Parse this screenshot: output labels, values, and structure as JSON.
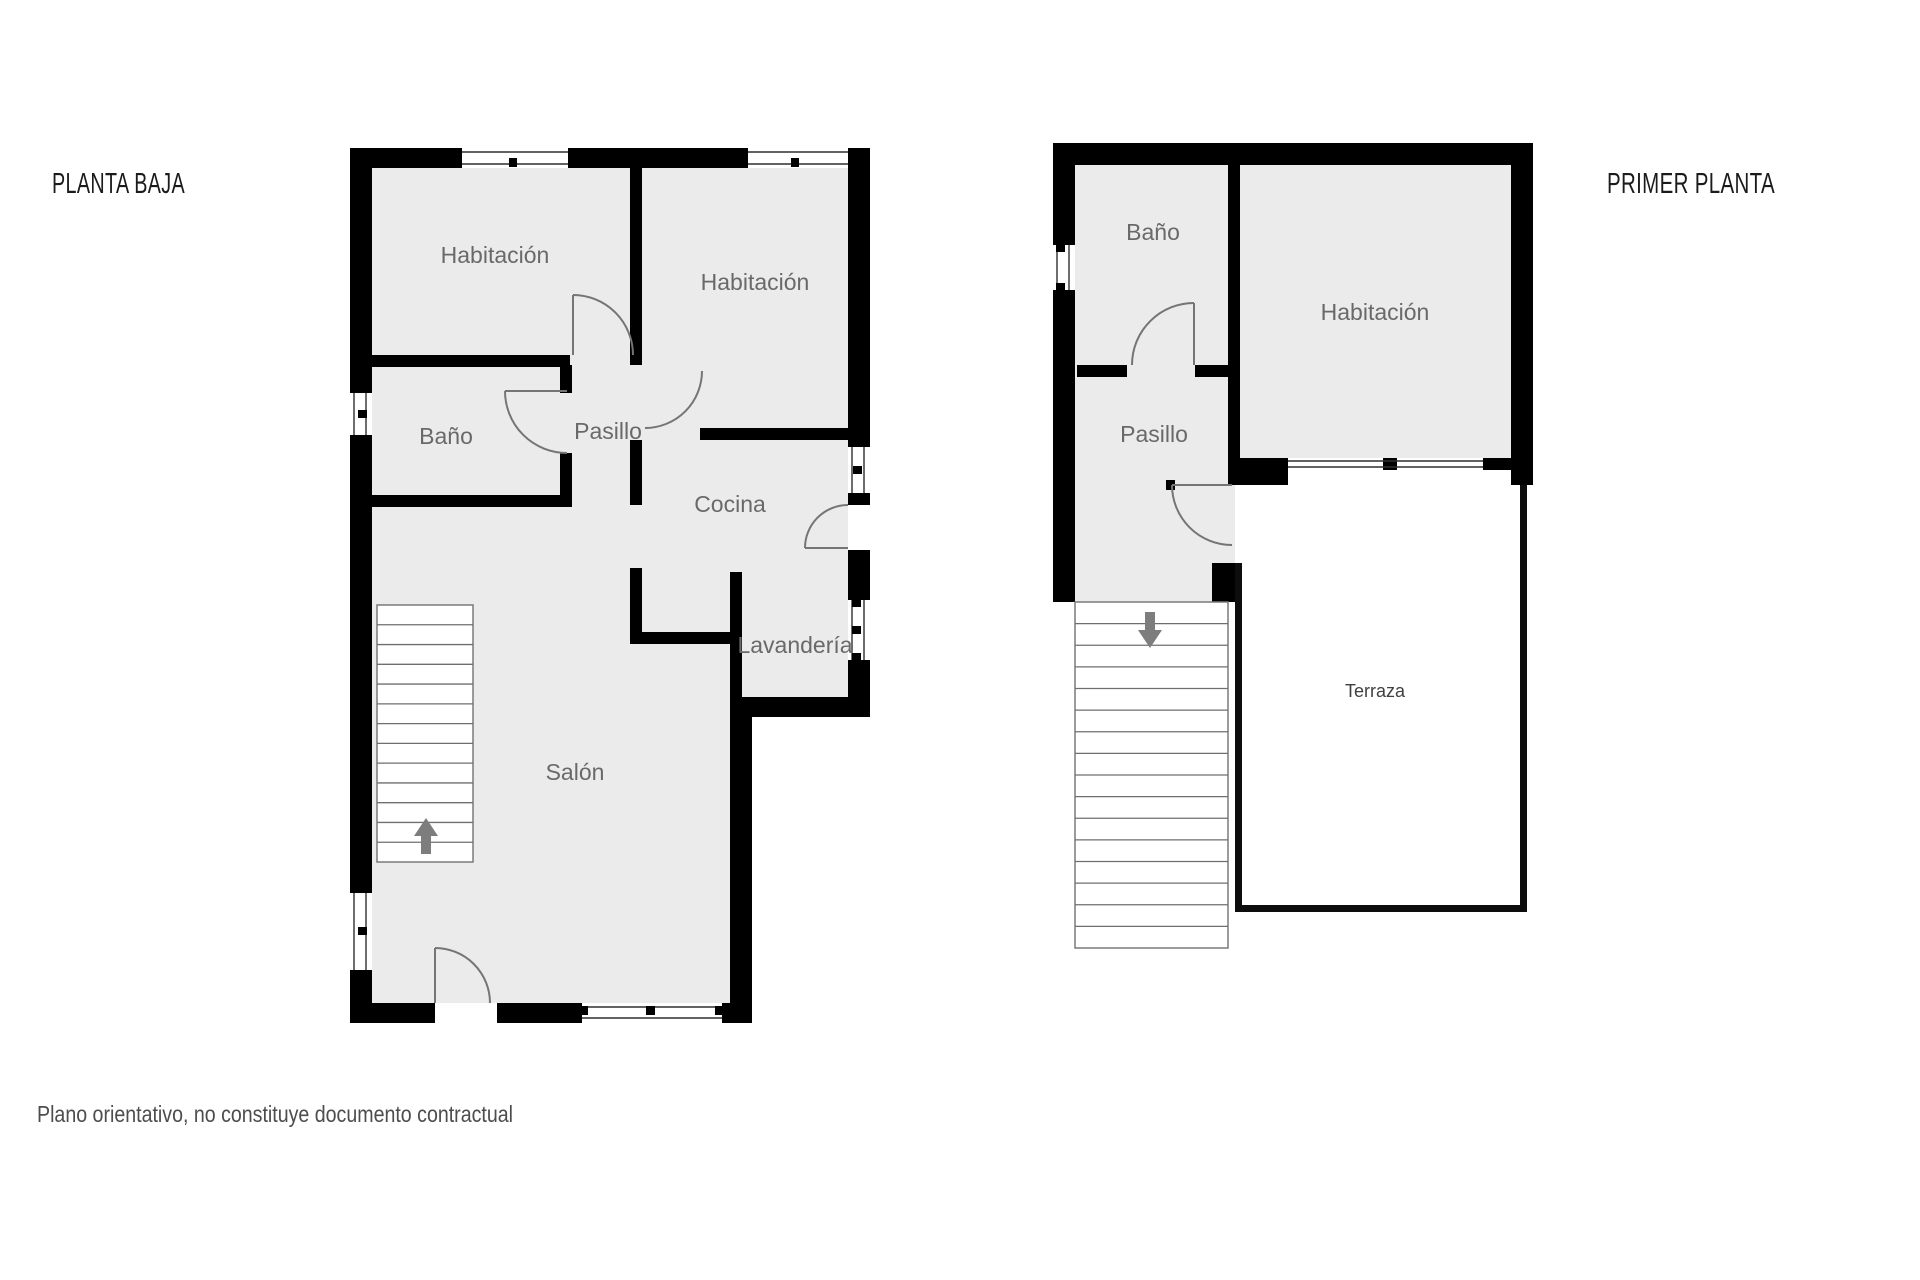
{
  "floors": [
    {
      "title": "PLANTA BAJA",
      "rooms": [
        {
          "label": "Habitación"
        },
        {
          "label": "Habitación"
        },
        {
          "label": "Baño"
        },
        {
          "label": "Pasillo"
        },
        {
          "label": "Cocina"
        },
        {
          "label": "Lavandería"
        },
        {
          "label": "Salón"
        }
      ],
      "stairs": {
        "steps": 13,
        "direction": "up"
      }
    },
    {
      "title": "PRIMER PLANTA",
      "rooms": [
        {
          "label": "Baño"
        },
        {
          "label": "Habitación"
        },
        {
          "label": "Pasillo"
        },
        {
          "label": "Terraza"
        }
      ],
      "stairs": {
        "steps": 16,
        "direction": "down"
      }
    }
  ],
  "disclaimer": "Plano orientativo, no constituye documento contractual",
  "colors": {
    "wall": "#000000",
    "room_fill": "#ebebeb",
    "terrace_fill": "#ffffff",
    "label": "#696969",
    "title": "#1b1b1b",
    "door_arc": "#757575",
    "stair_line": "#6f6f6f",
    "arrow": "#7d7d7d",
    "window_line": "#2f2f2f",
    "disclaimer": "#4d4d4d"
  }
}
